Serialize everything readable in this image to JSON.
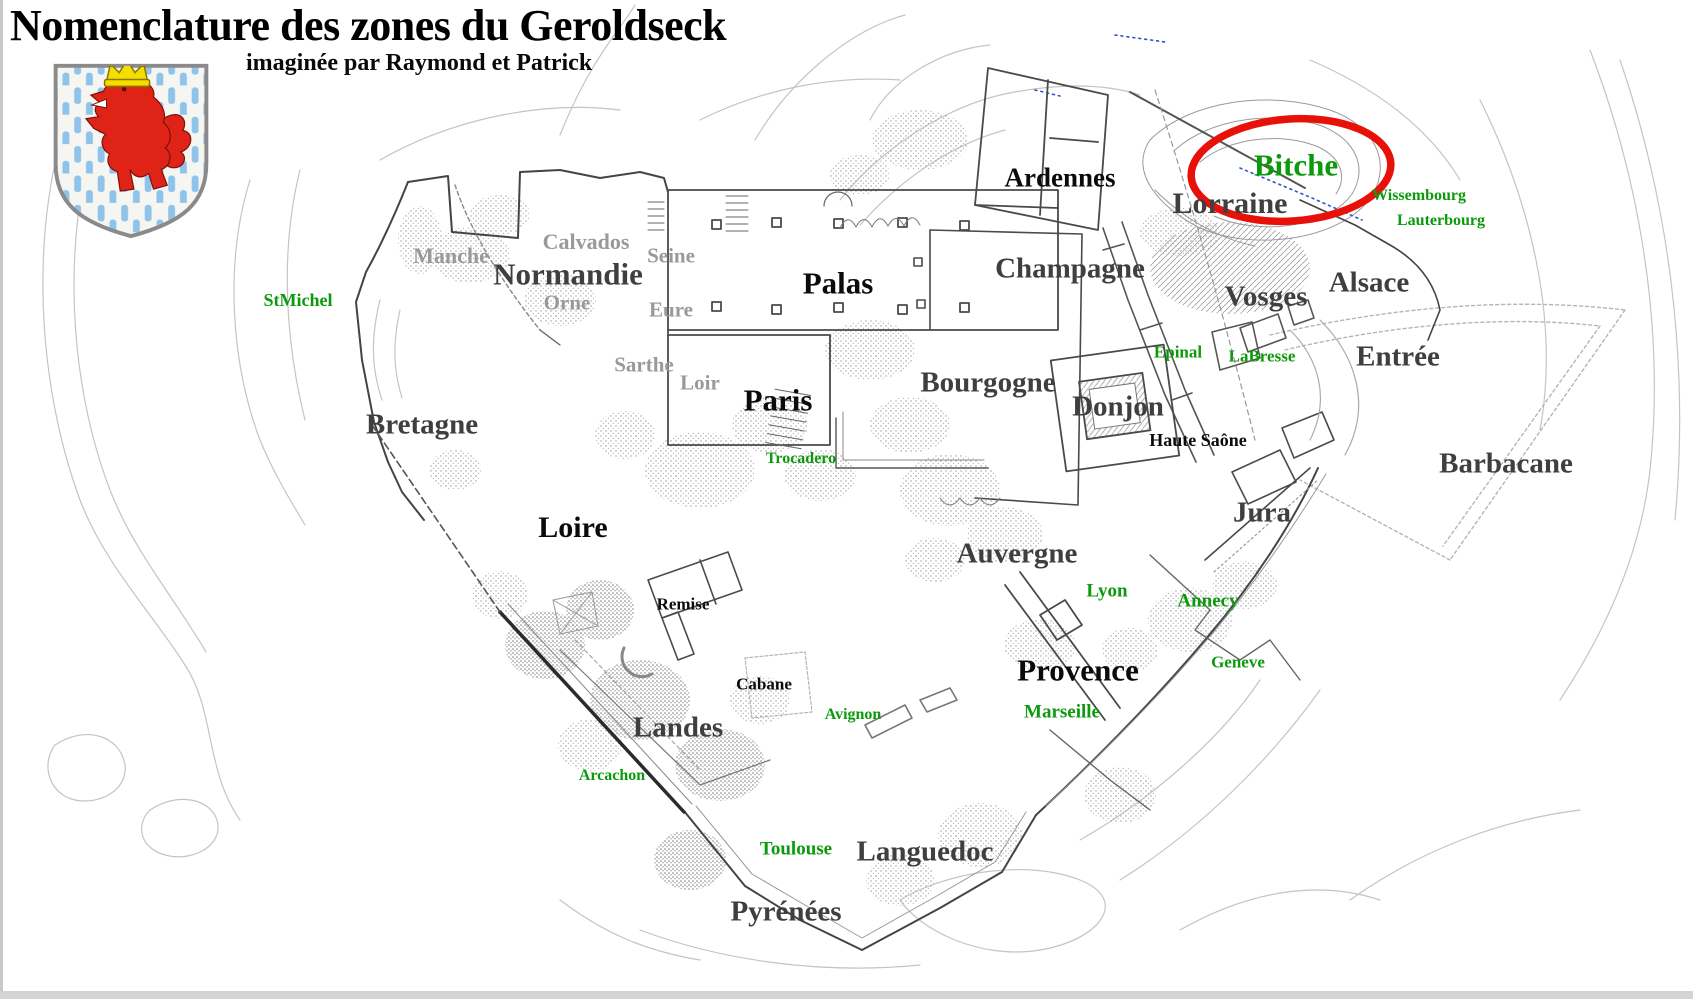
{
  "header": {
    "title": "Nomenclature des zones du Geroldseck",
    "subtitle": "imaginée par Raymond et Patrick"
  },
  "crest": {
    "description": "luxembourg-lion-shield",
    "field_color": "#f5f5f2",
    "stripe_color": "#8fc3ea",
    "lion_color": "#e02317",
    "crown_color": "#f5dd00",
    "border_color": "#8a8a8a"
  },
  "annotation": {
    "circled_zone": "Bitche",
    "circle_color": "#e81109"
  },
  "colors": {
    "zone_black": "#0b0b0b",
    "zone_dark_gray": "#3f3f3f",
    "zone_light_gray": "#999999",
    "place_green": "#0c9a0c",
    "wall_line": "#444444",
    "faint_contour": "#c4c4c4"
  },
  "labels": [
    {
      "text": "Ardennes",
      "x": 1060,
      "y": 178,
      "size": 27,
      "tone": "black"
    },
    {
      "text": "Bitche",
      "x": 1296,
      "y": 165,
      "size": 31,
      "tone": "green"
    },
    {
      "text": "Lorraine",
      "x": 1230,
      "y": 204,
      "size": 30,
      "tone": "dark"
    },
    {
      "text": "Wissembourg",
      "x": 1419,
      "y": 196,
      "size": 16,
      "tone": "green"
    },
    {
      "text": "Lauterbourg",
      "x": 1441,
      "y": 221,
      "size": 16,
      "tone": "green"
    },
    {
      "text": "Champagne",
      "x": 1070,
      "y": 269,
      "size": 29,
      "tone": "dark"
    },
    {
      "text": "Vosges",
      "x": 1266,
      "y": 297,
      "size": 29,
      "tone": "dark"
    },
    {
      "text": "Alsace",
      "x": 1369,
      "y": 283,
      "size": 29,
      "tone": "dark"
    },
    {
      "text": "Entrée",
      "x": 1398,
      "y": 357,
      "size": 29,
      "tone": "dark"
    },
    {
      "text": "Epinal",
      "x": 1178,
      "y": 352,
      "size": 17,
      "tone": "green"
    },
    {
      "text": "LaBresse",
      "x": 1262,
      "y": 356,
      "size": 17,
      "tone": "green"
    },
    {
      "text": "Donjon",
      "x": 1118,
      "y": 407,
      "size": 29,
      "tone": "dark"
    },
    {
      "text": "Haute Saône",
      "x": 1198,
      "y": 440,
      "size": 18,
      "tone": "black"
    },
    {
      "text": "Barbacane",
      "x": 1506,
      "y": 464,
      "size": 29,
      "tone": "dark"
    },
    {
      "text": "Jura",
      "x": 1262,
      "y": 513,
      "size": 29,
      "tone": "dark"
    },
    {
      "text": "Manche",
      "x": 451,
      "y": 256,
      "size": 22,
      "tone": "light"
    },
    {
      "text": "Calvados",
      "x": 586,
      "y": 242,
      "size": 22,
      "tone": "light"
    },
    {
      "text": "Seine",
      "x": 671,
      "y": 256,
      "size": 21,
      "tone": "light"
    },
    {
      "text": "Normandie",
      "x": 568,
      "y": 274,
      "size": 31,
      "tone": "dark"
    },
    {
      "text": "Orne",
      "x": 567,
      "y": 303,
      "size": 21,
      "tone": "light"
    },
    {
      "text": "Eure",
      "x": 671,
      "y": 310,
      "size": 21,
      "tone": "light"
    },
    {
      "text": "Sarthe",
      "x": 644,
      "y": 365,
      "size": 21,
      "tone": "light"
    },
    {
      "text": "Loir",
      "x": 700,
      "y": 383,
      "size": 21,
      "tone": "light"
    },
    {
      "text": "StMichel",
      "x": 298,
      "y": 300,
      "size": 18,
      "tone": "green"
    },
    {
      "text": "Palas",
      "x": 838,
      "y": 283,
      "size": 31,
      "tone": "black"
    },
    {
      "text": "Paris",
      "x": 778,
      "y": 400,
      "size": 31,
      "tone": "black"
    },
    {
      "text": "Bourgogne",
      "x": 988,
      "y": 383,
      "size": 29,
      "tone": "dark"
    },
    {
      "text": "Trocadero",
      "x": 801,
      "y": 459,
      "size": 16,
      "tone": "green"
    },
    {
      "text": "Bretagne",
      "x": 422,
      "y": 425,
      "size": 29,
      "tone": "dark"
    },
    {
      "text": "Loire",
      "x": 573,
      "y": 528,
      "size": 30,
      "tone": "black"
    },
    {
      "text": "Auvergne",
      "x": 1017,
      "y": 554,
      "size": 29,
      "tone": "dark"
    },
    {
      "text": "Lyon",
      "x": 1107,
      "y": 591,
      "size": 19,
      "tone": "green"
    },
    {
      "text": "Annecy",
      "x": 1208,
      "y": 601,
      "size": 19,
      "tone": "green"
    },
    {
      "text": "Geneve",
      "x": 1238,
      "y": 662,
      "size": 17,
      "tone": "green"
    },
    {
      "text": "Remise",
      "x": 683,
      "y": 604,
      "size": 17,
      "tone": "black"
    },
    {
      "text": "Provence",
      "x": 1078,
      "y": 670,
      "size": 31,
      "tone": "black"
    },
    {
      "text": "Cabane",
      "x": 764,
      "y": 684,
      "size": 17,
      "tone": "black"
    },
    {
      "text": "Avignon",
      "x": 853,
      "y": 715,
      "size": 16,
      "tone": "green"
    },
    {
      "text": "Marseille",
      "x": 1062,
      "y": 712,
      "size": 19,
      "tone": "green"
    },
    {
      "text": "Landes",
      "x": 678,
      "y": 728,
      "size": 29,
      "tone": "dark"
    },
    {
      "text": "Arcachon",
      "x": 612,
      "y": 776,
      "size": 16,
      "tone": "green"
    },
    {
      "text": "Toulouse",
      "x": 796,
      "y": 849,
      "size": 19,
      "tone": "green"
    },
    {
      "text": "Languedoc",
      "x": 925,
      "y": 852,
      "size": 29,
      "tone": "dark"
    },
    {
      "text": "Pyrénées",
      "x": 786,
      "y": 912,
      "size": 29,
      "tone": "dark"
    }
  ]
}
